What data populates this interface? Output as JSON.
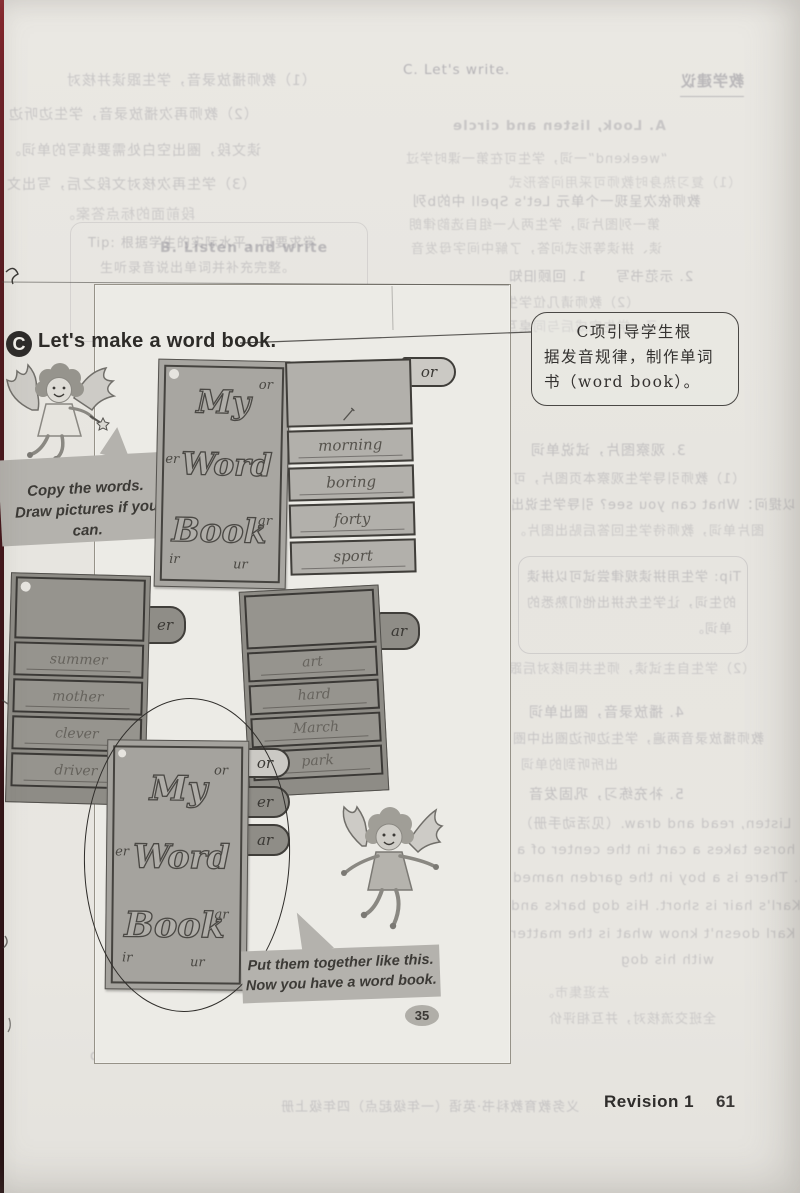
{
  "heading": {
    "badge": "C",
    "title": "Let's make a word book."
  },
  "callout": {
    "line1": "C项引导学生根",
    "line2": "据发音规律，制作单词",
    "line3": "书（word book）。"
  },
  "bubbles": {
    "bubble1_line1": "Copy the words.",
    "bubble1_line2": "Draw pictures if you can.",
    "bubble2_line1": "Put them together like this.",
    "bubble2_line2": "Now you have a word book."
  },
  "wordbook": {
    "cover_top": {
      "title": [
        "My",
        "Word",
        "Book"
      ],
      "letters": [
        "or",
        "er",
        "ar",
        "ir",
        "ur"
      ]
    },
    "cover_bottom": {
      "title": [
        "My",
        "Word",
        "Book"
      ],
      "letters": [
        "or",
        "er",
        "ar",
        "ir",
        "ur"
      ]
    },
    "page_or": {
      "tab": "or",
      "words": [
        "morning",
        "boring",
        "forty",
        "sport"
      ]
    },
    "card_er": {
      "tab": "er",
      "words": [
        "summer",
        "mother",
        "clever",
        "driver"
      ]
    },
    "card_ar": {
      "tab": "ar",
      "words": [
        "art",
        "hard",
        "March",
        "park"
      ]
    },
    "bottom_tabs": [
      "or",
      "er",
      "ar"
    ]
  },
  "panel": {
    "page_number": "35"
  },
  "footer": {
    "label": "Revision 1",
    "page_number": "61"
  },
  "ghost": [
    "C. Let's write.",
    "B. Listen and write",
    "Tip: 根据学生的实际水平，可要求学",
    "生听录音说出单词并补充完整。",
    "请学生根据职业内容回答问题，Wha",
    "does he/she often do on Saturday/Sunday?",
    "教学建议",
    "A. Look, listen and circle",
    "“weekend”一词，学生可在第一课时学过",
    "（1）复习热身时教师可采用问答形式",
    "教师依次呈现一个单元 Let's Spell 中的b列",
    "第一列图片词，学生两人一组自选韵律朗",
    "读、拼读等形式问答，了解中间字母发音",
    "2. 示范书写　　1. 回顾旧知",
    "（2）教师请几位学生上台展示所写句",
    "子。学生完成后与同桌互查，教师巡视指",
    "3. 观察图片，试说单词",
    "（1）教师引导学生观察本页图片，可",
    "以提问：What can you see? 引导学生说出",
    "图片单词，教师待学生回答后贴出图片。",
    "Tip: 学生用拼读规律尝试可以拼读",
    "的生词，让学生先拼出他们熟悉的",
    "单词。",
    "（2）学生自主试读，师生共同核对后跟",
    "4. 播放录音，圈出单词",
    "教师播放录音两遍，学生边听边圈出中圈",
    "出所听到的单词",
    "5. 补充练习，巩固发音",
    "Listen, read and draw.（见活动手册）",
    "A horse takes a cart in the center of a",
    "garden. There is a boy in the garden named",
    "Karl. Karl's hair is short. His dog barks and",
    "barks. Karl doesn't know what is the matter",
    "with his dog",
    "去逛集市。",
    "全班交流核对，并互相评价",
    "义务教育教科书·英语（一年级起点）四年级上册",
    "（1）教师播放录音，学生跟读并核对",
    "（2）教师再次播放录音，学生边听边",
    "读文段，圈出空白处需要填写的单词。",
    "（3）学生再次核对文段之后，写出文",
    "段前面的标点答案。"
  ]
}
